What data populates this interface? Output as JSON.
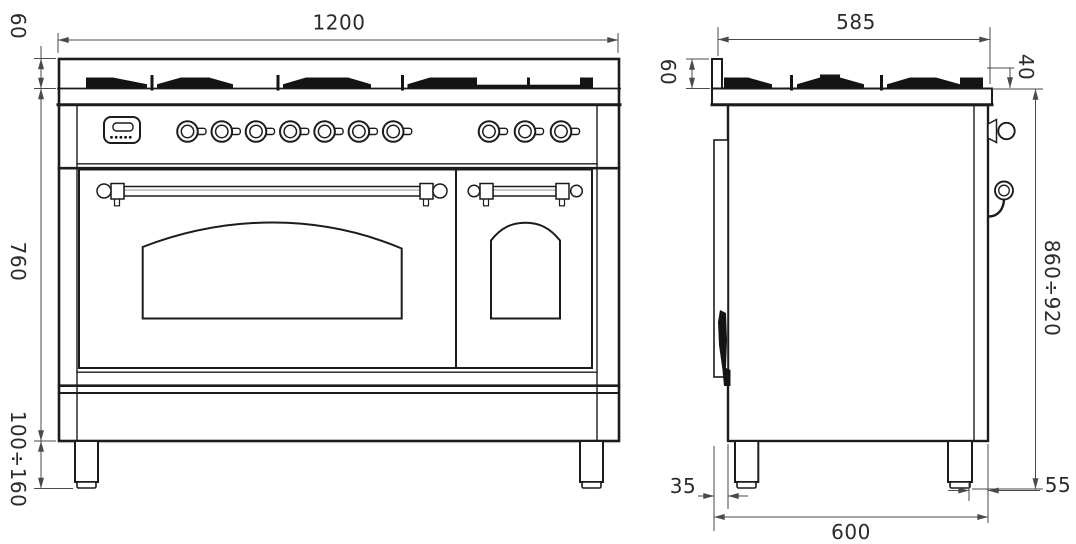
{
  "drawing": {
    "type": "technical-dimension-drawing",
    "subject": "double-oven range cooker, front and side elevations",
    "front_view": {
      "dimensions": {
        "overall_width": "1200",
        "hob_height": "60",
        "body_height": "760",
        "legs_height": "100÷160"
      }
    },
    "side_view": {
      "dimensions": {
        "top_depth": "585",
        "backguard_height": "60",
        "grate_height": "40",
        "height_to_worktop": "860÷920",
        "rear_clearance": "35",
        "front_leg_inset": "55",
        "overall_depth": "600"
      }
    },
    "colors": {
      "outline": "#1c1c1c",
      "dimension_line": "#4a4a4a",
      "grate_fill": "#141414",
      "background": "#ffffff"
    }
  }
}
